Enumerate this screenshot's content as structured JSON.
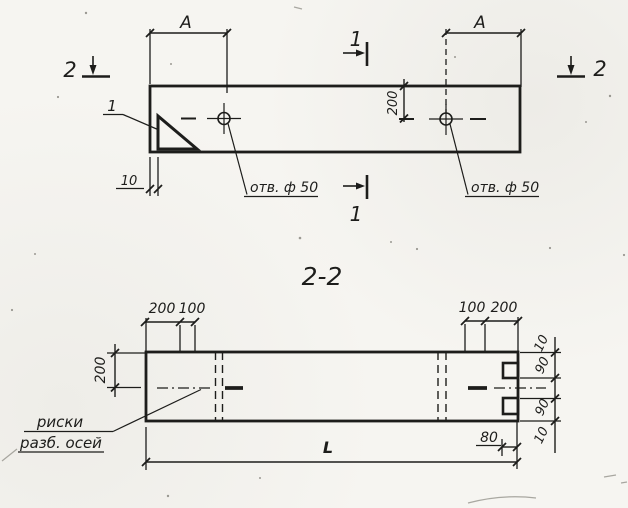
{
  "paper_color": "#f6f5f1",
  "ink_color": "#1d1d1b",
  "plan": {
    "section_mark_left": "2",
    "section_mark_right": "2",
    "section_mark_top": "1",
    "section_mark_bottom": "1",
    "dim_span_left": "A",
    "dim_span_right": "A",
    "dim_offset_to_axis": "200",
    "dim_edge_gap": "10",
    "detail_callout": "1",
    "hole_label_left": "отв. ф 50",
    "hole_label_right": "отв. ф 50"
  },
  "section": {
    "title": "2-2",
    "dims_top_left": [
      "200",
      "100"
    ],
    "dims_top_right": [
      "100",
      "200"
    ],
    "dim_left_vertical": "200",
    "dims_right_vertical": [
      "10",
      "90",
      "90",
      "10"
    ],
    "dim_notch_depth": "80",
    "dim_total_length": "L",
    "axis_marks_note_line1": "риски",
    "axis_marks_note_line2": "разб. осей"
  }
}
